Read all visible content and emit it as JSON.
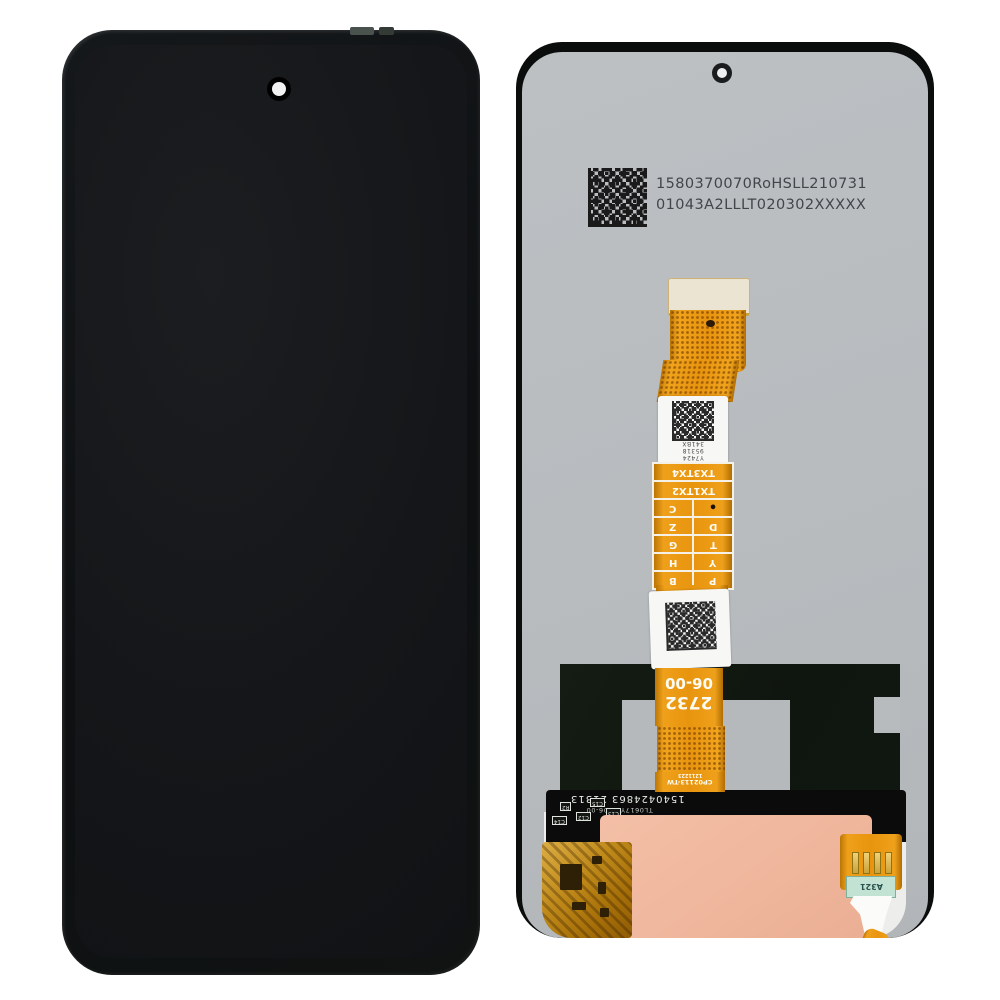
{
  "product": {
    "view_left": "front display assembly",
    "view_right": "back of display assembly"
  },
  "back": {
    "serial_label": {
      "line1": "1580370070RoHSLL210731",
      "line2": "01043A2LLLT020302XXXXX"
    },
    "flex": {
      "label1_lines": [
        "Y7424",
        "95318",
        "341BX"
      ],
      "testpoints": {
        "header1": "TX3TX4",
        "header2": "TX1TX2",
        "pairs": [
          [
            "C",
            "•"
          ],
          [
            "Z",
            "D"
          ],
          [
            "G",
            "T"
          ],
          [
            "H",
            "Y"
          ],
          [
            "B",
            "P"
          ]
        ]
      },
      "codes": {
        "model": "2732",
        "version": "06-00",
        "part": "CP02113-TW",
        "batch": "1211223"
      }
    },
    "pcb": {
      "silkscreen_line1": "1540424863 21313",
      "silkscreen_line2": "TL0617YWH06-00",
      "component_refs": [
        "C13",
        "C15",
        "C12",
        "R2",
        "C14"
      ]
    },
    "connector_label": "A321"
  },
  "colors": {
    "flex_orange": "#e8940e",
    "back_panel_gray": "#b8bcbf",
    "adhesive_peach": "#efb69c",
    "graphite_panel": "#10170f",
    "front_black": "#121416"
  }
}
